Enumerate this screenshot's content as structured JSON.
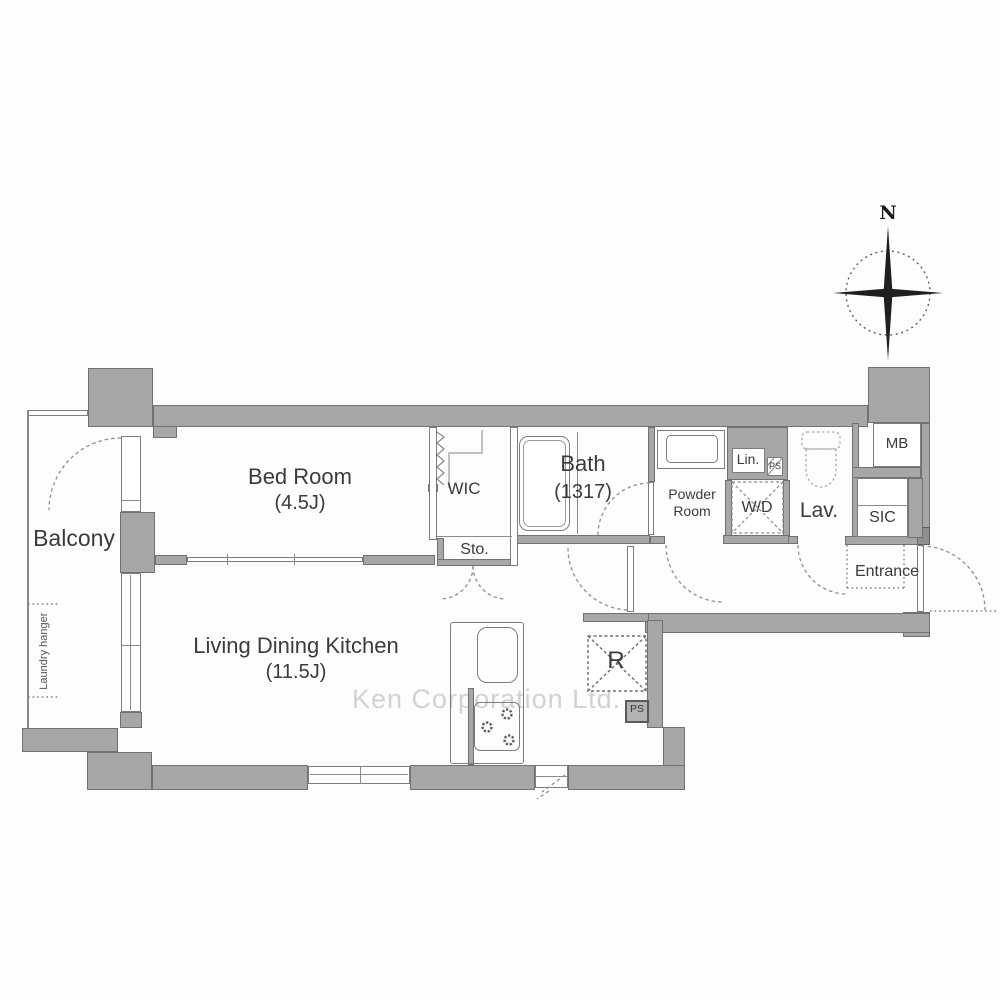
{
  "plan": {
    "watermark": "Ken Corporation Ltd.",
    "compass": {
      "north_label": "N"
    },
    "rooms": {
      "balcony": {
        "label": "Balcony"
      },
      "laundry_hanger": {
        "label": "Laundry hanger"
      },
      "bedroom": {
        "label": "Bed Room",
        "size": "(4.5J)"
      },
      "ldk": {
        "label": "Living Dining Kitchen",
        "size": "(11.5J)"
      },
      "wic": {
        "label": "WIC"
      },
      "storage": {
        "label": "Sto."
      },
      "bath": {
        "label": "Bath",
        "size": "(1317)"
      },
      "powder_room": {
        "label_line1": "Powder",
        "label_line2": "Room"
      },
      "linen": {
        "label": "Lin."
      },
      "pipe_space_upper": {
        "label": "PS"
      },
      "washer_dryer": {
        "label": "W/D"
      },
      "lavatory": {
        "label": "Lav."
      },
      "meter_box": {
        "label": "MB"
      },
      "shoe_closet": {
        "label": "SIC"
      },
      "entrance": {
        "label": "Entrance"
      },
      "refrigerator": {
        "label": "R"
      },
      "pipe_space_lower": {
        "label": "PS"
      }
    },
    "colors": {
      "wall_fill": "#a7a7a7",
      "wall_edge": "#717171",
      "thin_line": "#8a8a8a",
      "text": "#3b3b3b",
      "watermark": "#c3c3c3"
    }
  }
}
